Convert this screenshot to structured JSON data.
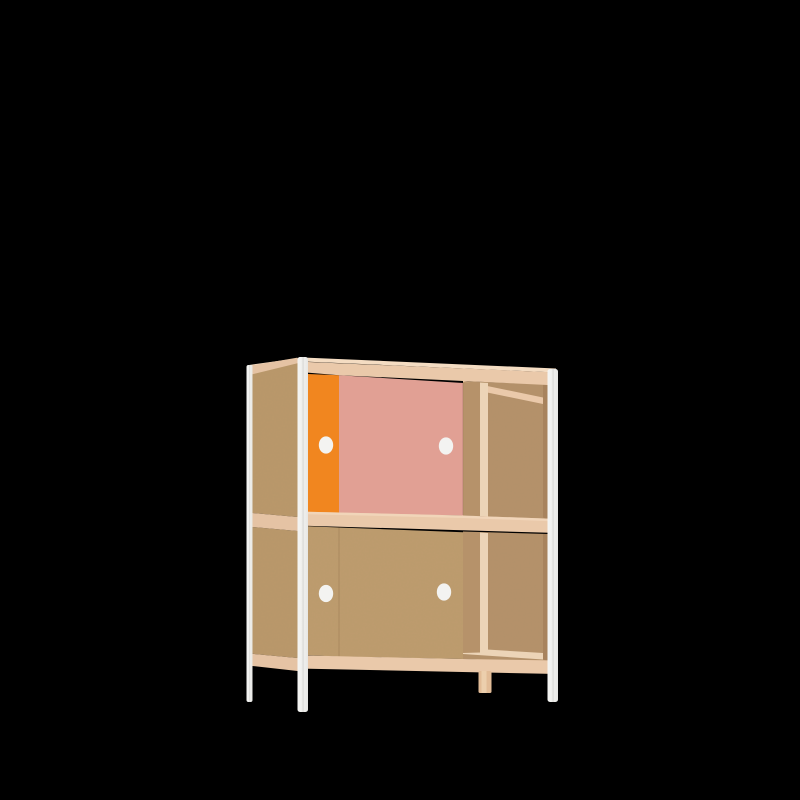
{
  "scene": {
    "background_color": "#000000",
    "object_label": "two-shelf plywood cabinet with sliding doors, right sections open"
  },
  "colors": {
    "background": "#000000",
    "mdf": "#BE9C6E",
    "mdf_side": "#BA986B",
    "mdf_interior": "#B5916A",
    "mdf_interior_dark": "#A8835D",
    "mdf_divider": "#B6926A",
    "edge_light": "#ECD4B7",
    "wood_top_light": "#F4DCC2",
    "wood_band": "#EAC9AA",
    "wood_band_side": "#E5C3A4",
    "door_orange": "#F1861F",
    "door_pink": "#E1A094",
    "handle_white": "#F3F3F1",
    "leg_back_tan": "#E2BC97",
    "leg_back_tan_light": "#EDD0AF",
    "frame_white": "#EFEFED"
  }
}
